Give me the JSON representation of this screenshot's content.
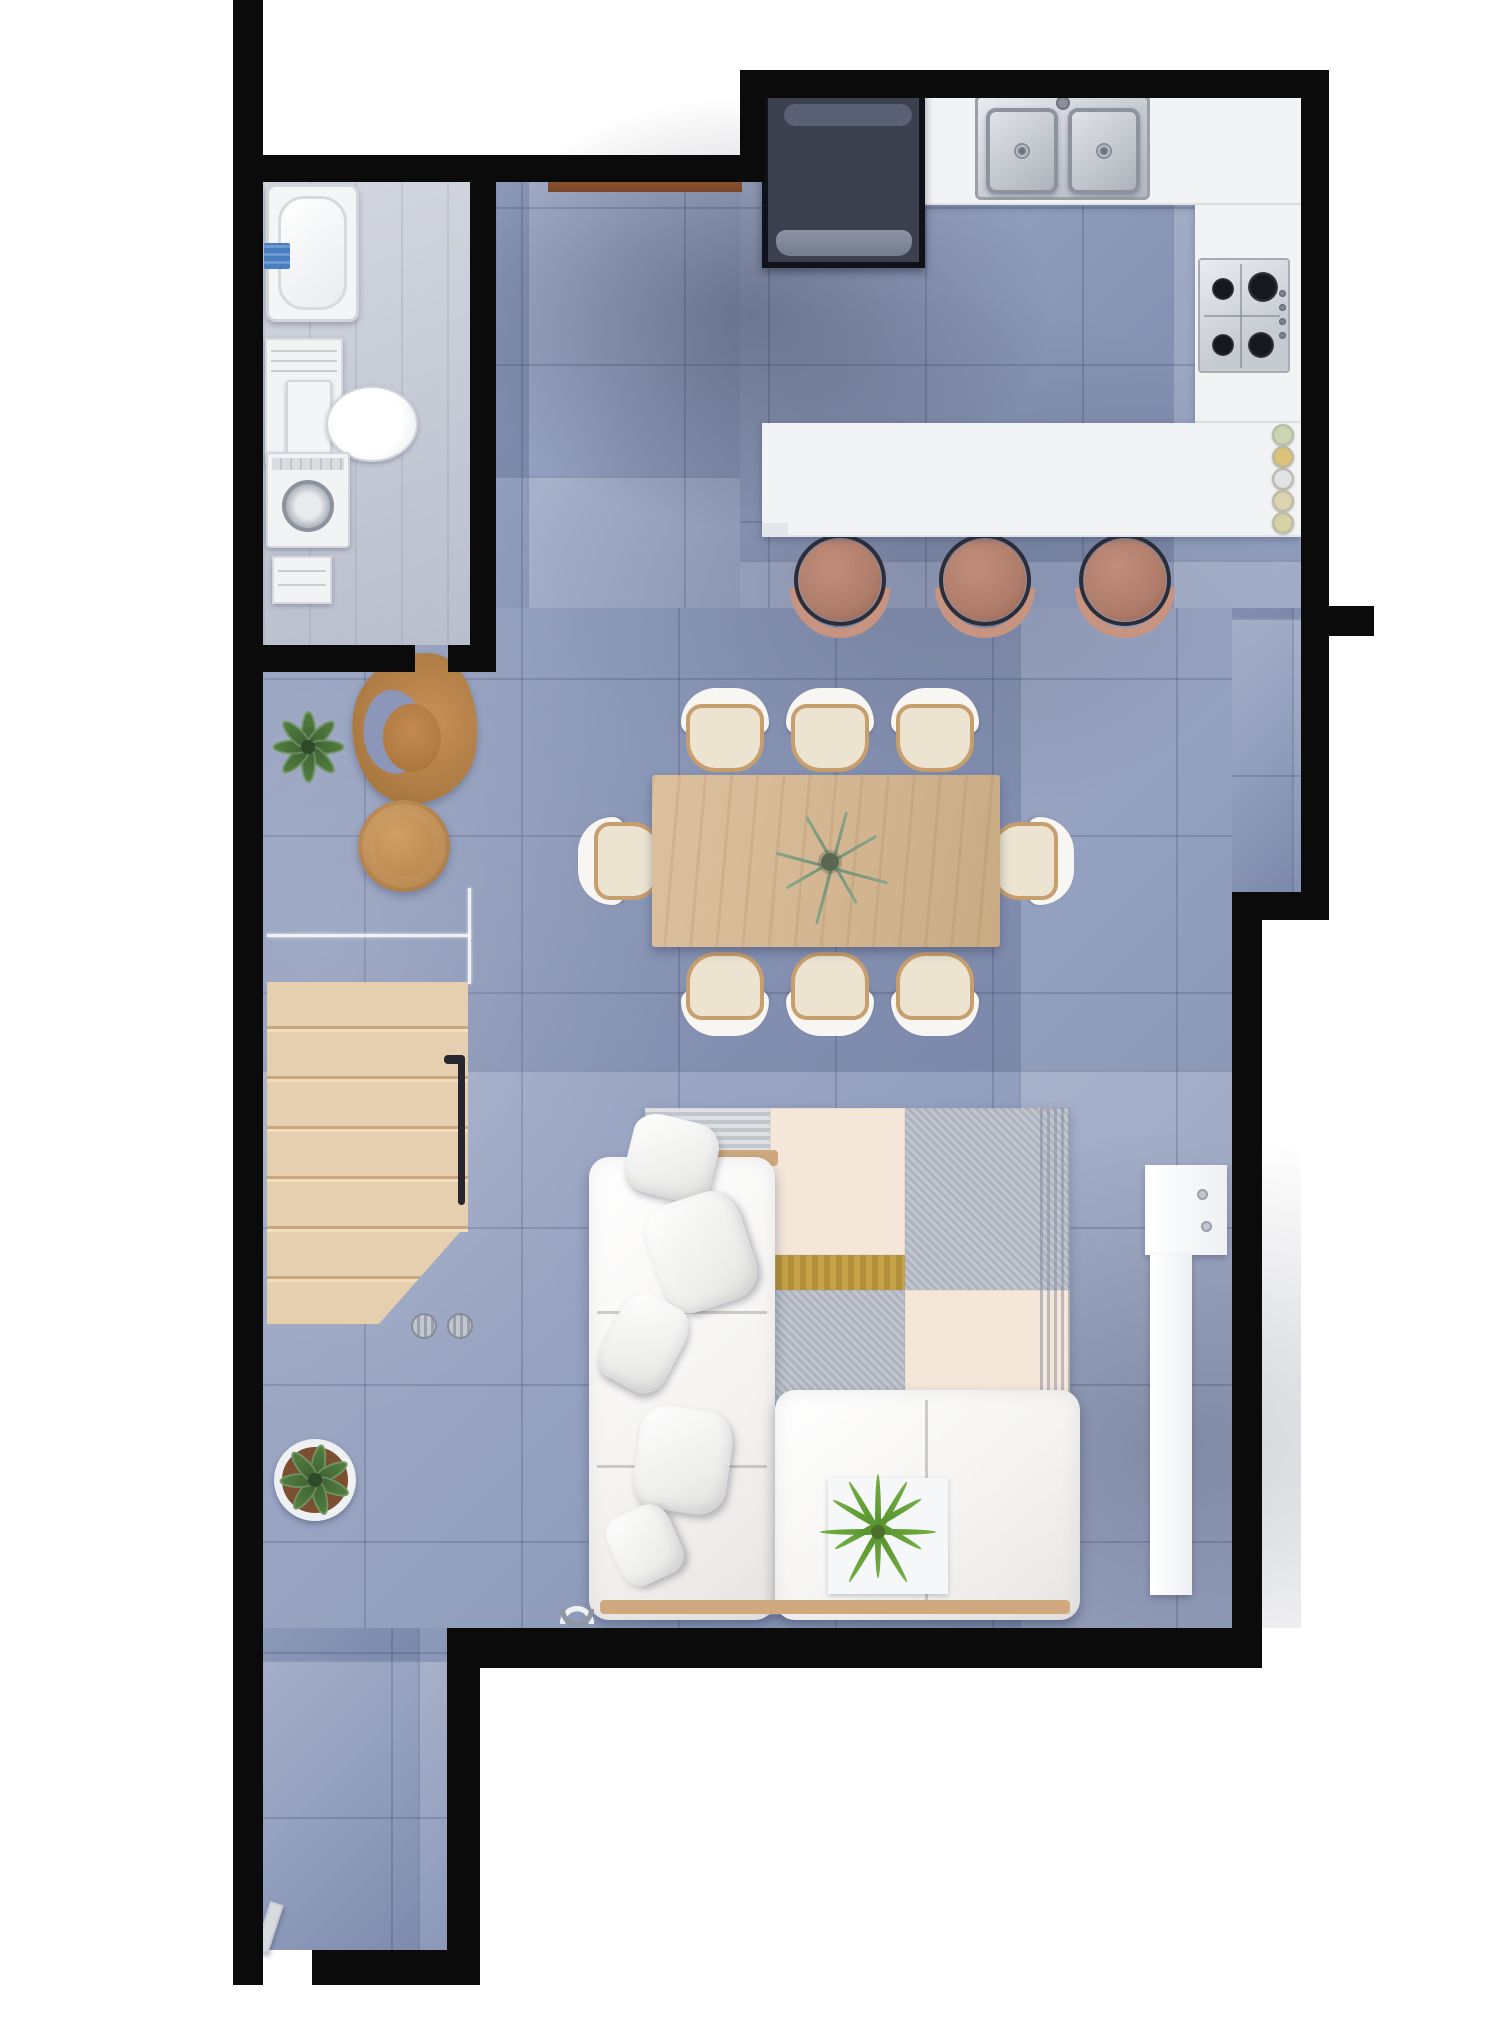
{
  "scene": {
    "type": "architectural-floor-plan-3d-render",
    "view": "top-down",
    "width_px": 1488,
    "height_px": 2029,
    "background": "#ffffff"
  },
  "palette": {
    "wall": "#0b0b0c",
    "floor": "#94a0bf",
    "floorLight": "#a8b1ca",
    "floorDark": "#7c88aa",
    "grid": "rgba(52,62,94,.22)",
    "bathFloor": "#c6cad4",
    "counter": "#f2f3f5",
    "appliance": "#3c4150",
    "applianceTrim": "#5a6175",
    "stool": "#b07d6b",
    "stoolArc": "#c69480",
    "stoolRing": "#2d2d38",
    "tableWood": "#dcc09e",
    "chairWood": "#c79e6e",
    "cushion": "#ece4d0",
    "shell": "#f7f6f2",
    "stairWood": "#e6cfae",
    "sofa": "#f5f4f2",
    "sofaWoodTrim": "#cfa97d",
    "rugCream": "#f4e6d8",
    "rugPeach": "#f9e4d2",
    "rugGold": "#b3903a",
    "plantGreen": "#53803f",
    "plantDark": "#3c5f33",
    "fernGreen": "#74b041",
    "towelBlue": "#4a7ec0",
    "thresholdBrown": "#7a4527"
  },
  "rooms": [
    {
      "id": "bathroom-laundry",
      "fixtures": [
        "bathtub",
        "blue-towel",
        "vanity-shelf",
        "toilet",
        "washing-machine"
      ]
    },
    {
      "id": "kitchen",
      "fixtures": [
        "refrigerator",
        "double-basin-sink",
        "l-shaped-counter",
        "gas-cooktop-4-burner",
        "island-breakfast-bar",
        "bar-stools",
        "stacked-plates"
      ]
    },
    {
      "id": "dining-area",
      "fixtures": [
        "rectangular-wood-table",
        "upholstered-chairs",
        "eucalyptus-centerpiece"
      ]
    },
    {
      "id": "reading-corner",
      "fixtures": [
        "curved-wood-lounge-chair",
        "round-side-table",
        "potted-plant"
      ]
    },
    {
      "id": "stair-hall",
      "fixtures": [
        "wood-staircase",
        "black-handrail",
        "glass-balustrade",
        "potted-plant",
        "gray-cylinders"
      ]
    },
    {
      "id": "living-room",
      "fixtures": [
        "white-sectional-sofa",
        "throw-pillows",
        "patchwork-area-rug",
        "fern-plant-on-mat",
        "white-console"
      ]
    }
  ],
  "counts": {
    "bar_stools": 3,
    "dining_chairs": 8,
    "plates": 5,
    "pillows": 5,
    "plants": 4,
    "cooktop_burners": 4,
    "sink_basins": 2,
    "stair_treads": 7,
    "door_openings": 3
  }
}
